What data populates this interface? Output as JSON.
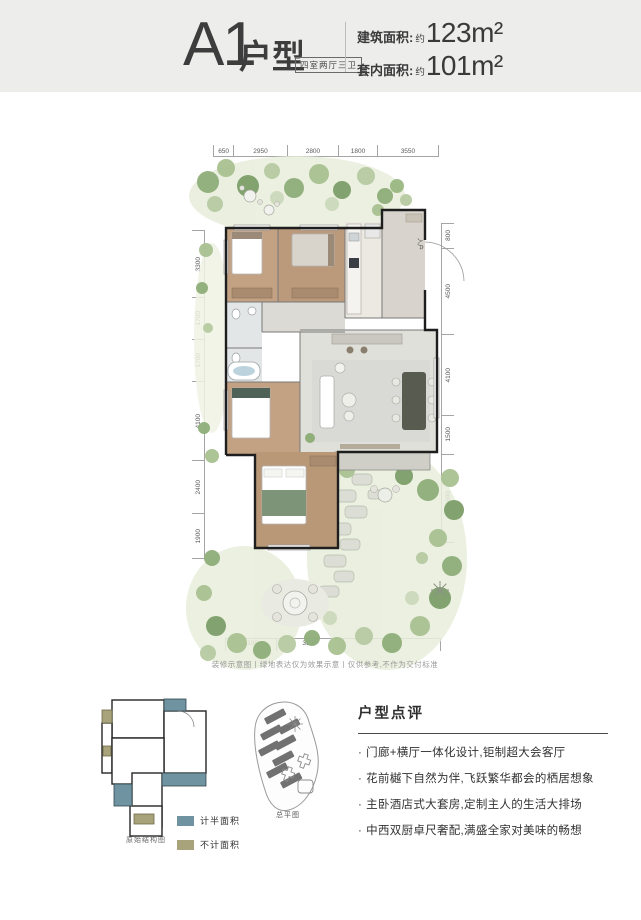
{
  "header": {
    "unit_code": "A1",
    "unit_type": "户型",
    "layout_tag": "四室两厅三卫",
    "metrics": [
      {
        "label": "建筑面积:",
        "approx": "约",
        "value": "123m²"
      },
      {
        "label": "套内面积:",
        "approx": "约",
        "value": "101m²"
      }
    ]
  },
  "floorplan": {
    "dims_top": [
      "650",
      "2950",
      "2800",
      "1800",
      "3550"
    ],
    "dims_left": [
      "3300",
      "1700",
      "1700",
      "4100",
      "2400",
      "1900"
    ],
    "dims_right": [
      "800",
      "4500",
      "4100",
      "1500",
      "4600"
    ],
    "dims_bottom": [
      "2100",
      "3100",
      "4900"
    ],
    "entry_label": "入户",
    "disclaimer": "装修示意图丨绿地表达仅为效果示意丨仅供参考,不作为交付标准"
  },
  "footer": {
    "structure_caption": "原始结构图",
    "legend": [
      {
        "label": "计半面积",
        "color": "#6f93a0"
      },
      {
        "label": "不计面积",
        "color": "#a9a37b"
      }
    ],
    "siteplan_caption": "总平图",
    "review": {
      "title": "户型点评",
      "marker": "·",
      "bullets": [
        "门廊+横厅一体化设计,钜制超大会客厅",
        "花前樾下自然为伴,飞跃繁华都会的栖居想象",
        "主卧酒店式大套房,定制主人的生活大排场",
        "中西双厨卓尺奢配,满盛全家对美味的畅想"
      ]
    }
  },
  "colors": {
    "header_bg": "#ededec",
    "text_dark": "#3c3c3c",
    "garden_green": "#8fae7a",
    "wood_floor": "#c3a284",
    "wall": "#1e1e1e"
  }
}
